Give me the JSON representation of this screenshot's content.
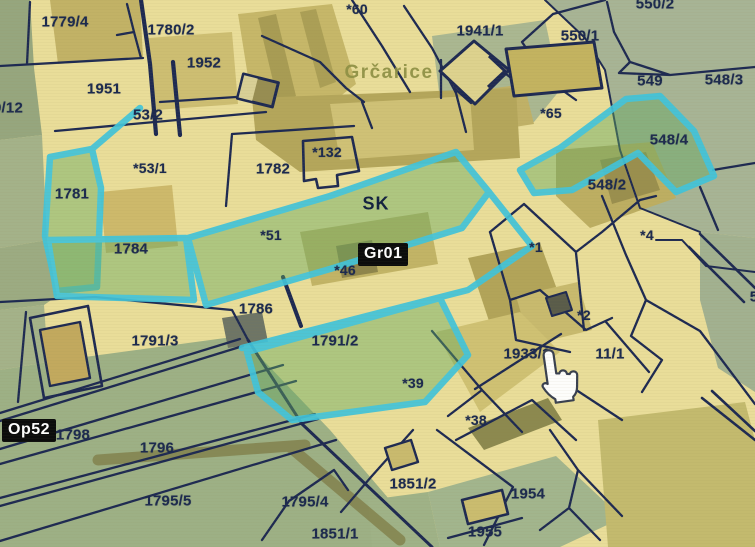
{
  "map": {
    "place_name": "Grčarice",
    "settlement_code": "SK",
    "sheet_badge": "Gr01",
    "op_badge": "Op52",
    "cursor": {
      "type": "hand-pointer",
      "x": 558,
      "y": 374
    },
    "highlighted_parcel_ids": [
      "1781",
      "1784",
      "*51",
      "1791/2",
      "548/4"
    ],
    "colors": {
      "background": "#e9dd99",
      "meadow_green": "#9db085",
      "grey_green": "#a7b495",
      "olive": "#c0b165",
      "boundary_navy": "#1e2a52",
      "label_navy": "#1c2a4e",
      "highlight_cyan": "#41c4da",
      "highlight_fill_green": "rgba(98,168,96,0.48)",
      "badge_bg": "#0c0c0c",
      "badge_text": "#ffffff",
      "place_label": "#8e9045"
    },
    "parcel_labels": [
      {
        "text": "1779/4",
        "x": 65,
        "y": 22
      },
      {
        "text": "1780/2",
        "x": 171,
        "y": 30
      },
      {
        "text": "1952",
        "x": 204,
        "y": 63
      },
      {
        "text": "1951",
        "x": 104,
        "y": 89
      },
      {
        "text": "9/12",
        "x": 8,
        "y": 108
      },
      {
        "text": "53/2",
        "x": 148,
        "y": 115
      },
      {
        "text": "*53/1",
        "x": 150,
        "y": 168,
        "cls": "sm"
      },
      {
        "text": "1782",
        "x": 273,
        "y": 169
      },
      {
        "text": "*132",
        "x": 327,
        "y": 152,
        "cls": "sm"
      },
      {
        "text": "*60",
        "x": 357,
        "y": 9,
        "cls": "sm"
      },
      {
        "text": "1941/1",
        "x": 480,
        "y": 31
      },
      {
        "text": "550/2",
        "x": 655,
        "y": 4
      },
      {
        "text": "550/1",
        "x": 580,
        "y": 36
      },
      {
        "text": "549",
        "x": 650,
        "y": 81
      },
      {
        "text": "548/3",
        "x": 724,
        "y": 80
      },
      {
        "text": "*65",
        "x": 551,
        "y": 113,
        "cls": "sm"
      },
      {
        "text": "548/4",
        "x": 669,
        "y": 140
      },
      {
        "text": "548/2",
        "x": 607,
        "y": 185
      },
      {
        "text": "1781",
        "x": 72,
        "y": 194
      },
      {
        "text": "1784",
        "x": 131,
        "y": 249
      },
      {
        "text": "*51",
        "x": 271,
        "y": 235,
        "cls": "sm"
      },
      {
        "text": "*46",
        "x": 345,
        "y": 270,
        "cls": "sm"
      },
      {
        "text": "*1",
        "x": 536,
        "y": 247,
        "cls": "sm"
      },
      {
        "text": "*4",
        "x": 647,
        "y": 235,
        "cls": "sm"
      },
      {
        "text": "*2",
        "x": 584,
        "y": 315,
        "cls": "sm"
      },
      {
        "text": "1786",
        "x": 256,
        "y": 309
      },
      {
        "text": "1791/2",
        "x": 335,
        "y": 341
      },
      {
        "text": "1791/3",
        "x": 155,
        "y": 341
      },
      {
        "text": "1933/1",
        "x": 527,
        "y": 354
      },
      {
        "text": "11/1",
        "x": 610,
        "y": 354
      },
      {
        "text": "*39",
        "x": 413,
        "y": 383,
        "cls": "sm"
      },
      {
        "text": "*38",
        "x": 476,
        "y": 420,
        "cls": "sm"
      },
      {
        "text": "1798",
        "x": 73,
        "y": 435
      },
      {
        "text": "1796",
        "x": 157,
        "y": 448
      },
      {
        "text": "1795/5",
        "x": 168,
        "y": 501
      },
      {
        "text": "1795/4",
        "x": 305,
        "y": 502
      },
      {
        "text": "1851/1",
        "x": 335,
        "y": 534
      },
      {
        "text": "1851/2",
        "x": 413,
        "y": 484
      },
      {
        "text": "1954",
        "x": 528,
        "y": 494
      },
      {
        "text": "1955",
        "x": 485,
        "y": 532
      },
      {
        "text": "5",
        "x": 754,
        "y": 297
      }
    ]
  }
}
